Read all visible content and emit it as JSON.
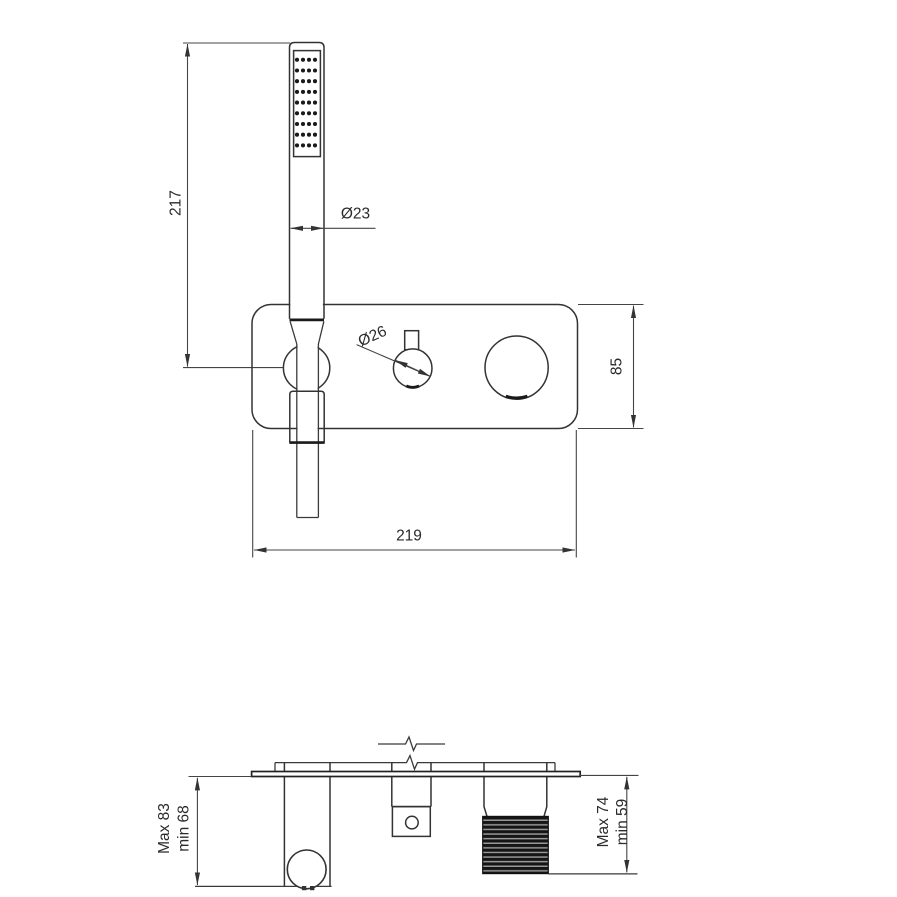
{
  "drawing": {
    "labels": {
      "front": {
        "hose_length": "217",
        "handshower_dia": "Ø23",
        "knob_dia": "Ø26",
        "plate_height": "85",
        "plate_width": "219"
      },
      "side": {
        "left_max": "Max 83",
        "left_min": "min 68",
        "right_max": "Max 74",
        "right_min": "min 59"
      }
    },
    "spray_grid": {
      "rows": 9,
      "cols": 4
    },
    "colors": {
      "line": "#333333",
      "text": "#2a2a2a",
      "background": "#ffffff"
    }
  }
}
